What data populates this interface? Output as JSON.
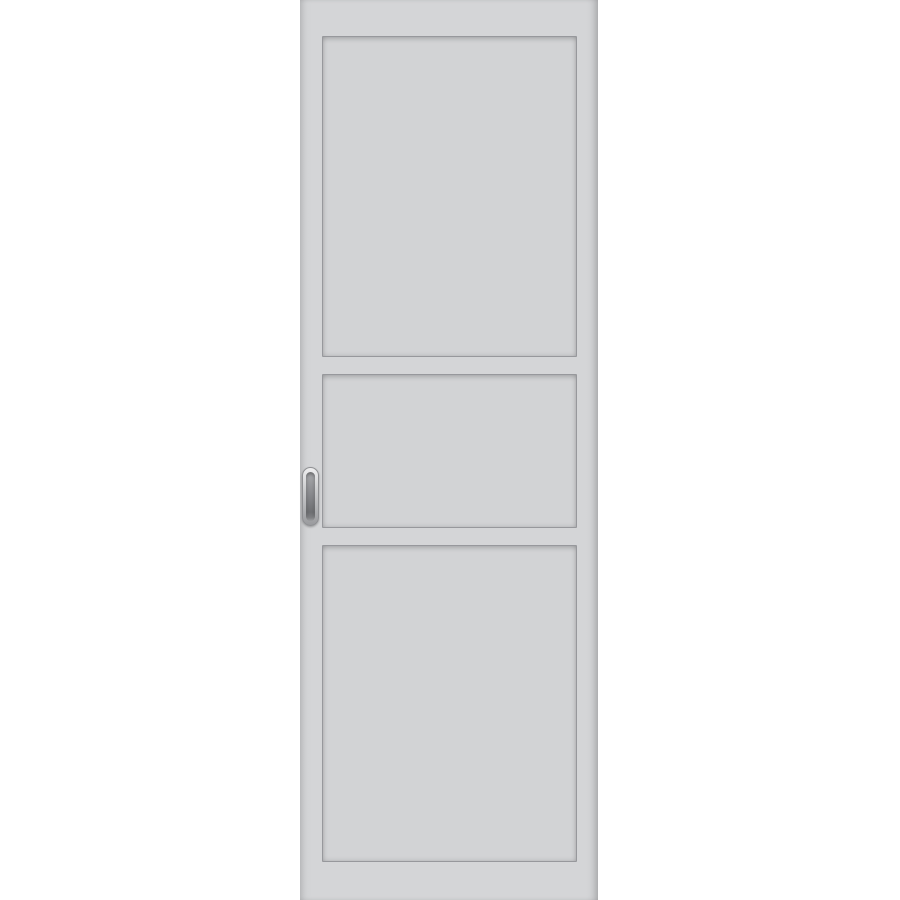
{
  "scene": {
    "type": "product-image",
    "subject": "White three-panel sliding door leaf",
    "background_color": "#ffffff",
    "door": {
      "label": "door-leaf",
      "surface_color": "#d4d5d7",
      "groove_color": "#97989c",
      "edge_shadow_color": "#c4c5c8",
      "panel_count": 3,
      "panels": [
        {
          "name": "top-panel"
        },
        {
          "name": "middle-panel"
        },
        {
          "name": "bottom-panel"
        }
      ],
      "handle": {
        "label": "recessed oval flush pull handle",
        "finish": "satin metal",
        "rim_color": "#c9cacc",
        "recess_color": "#7d7e81"
      }
    }
  }
}
